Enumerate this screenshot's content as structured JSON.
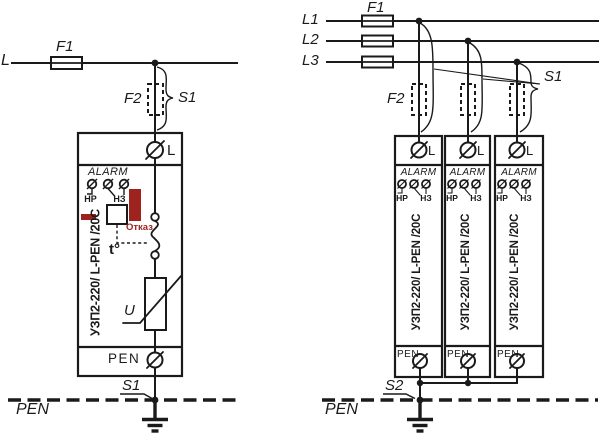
{
  "colors": {
    "wire": "#1a1a1a",
    "indicator_red": "#9e231f",
    "background": "#ffffff"
  },
  "diagram": {
    "left": {
      "line_label": "L",
      "fuse1_label": "F1",
      "fuse2_label": "F2",
      "disconnect_top_label": "S1",
      "module": {
        "terminal_l": "L",
        "alarm_label": "ALARM",
        "contact_no": "НР",
        "contact_nc": "НЗ",
        "fail_label": "Отказ",
        "thermal_label": "t°",
        "varistor_label": "U",
        "model": "УЗП2-220/ L-PEN /20C",
        "terminal_pen": "PEN"
      },
      "disconnect_bottom_label": "S1",
      "bus_label": "PEN"
    },
    "right": {
      "line_labels": [
        "L1",
        "L2",
        "L3"
      ],
      "fuse1_label": "F1",
      "fuse2_label": "F2",
      "disconnect_top_label": "S1",
      "modules": [
        {
          "terminal_l": "L",
          "alarm_label": "ALARM",
          "contact_no": "НР",
          "contact_nc": "НЗ",
          "model": "УЗП2-220/ L-PEN /20C",
          "terminal_pen": "PEN"
        },
        {
          "terminal_l": "L",
          "alarm_label": "ALARM",
          "contact_no": "НР",
          "contact_nc": "НЗ",
          "model": "УЗП2-220/ L-PEN /20C",
          "terminal_pen": "PEN"
        },
        {
          "terminal_l": "L",
          "alarm_label": "ALARM",
          "contact_no": "НР",
          "contact_nc": "НЗ",
          "model": "УЗП2-220/ L-PEN /20C",
          "terminal_pen": "PEN"
        }
      ],
      "disconnect_bottom_label": "S2",
      "bus_label": "PEN"
    }
  }
}
